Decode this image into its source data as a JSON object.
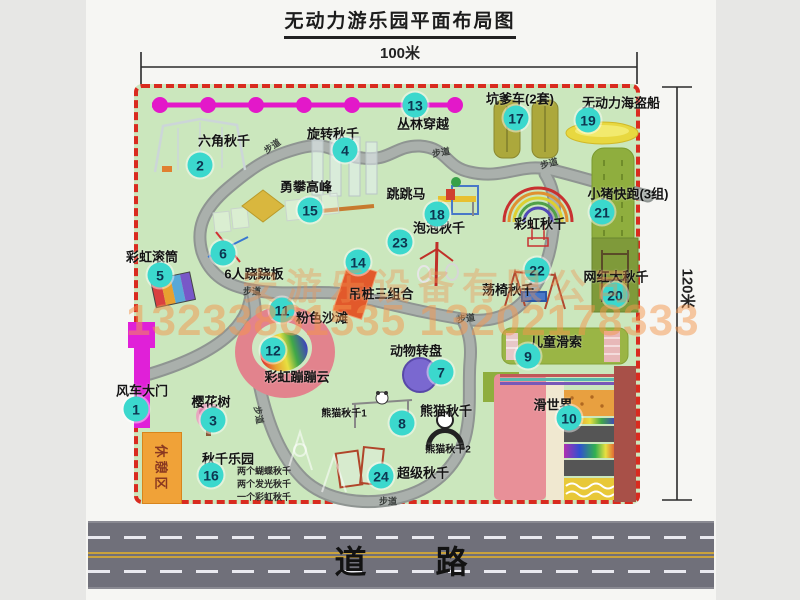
{
  "title": "无动力游乐园平面布局图",
  "dimensions": {
    "width_label": "100米",
    "height_label": "120米"
  },
  "road": {
    "label": "道 路"
  },
  "watermark": {
    "company": "安游乐设备有限公司",
    "phone": "13233861535 13202178333"
  },
  "rest_area_label": "休憩区",
  "walkway_label": "步道",
  "colors": {
    "map-green": "#cbe7bd",
    "border-red": "#d92b1f",
    "badge": "#3bd8cd",
    "road": "#70707a",
    "rest-orange": "#f0a238",
    "magenta": "#e318c9",
    "wm1": "rgba(240,145,80,0.38)",
    "wm2": "rgba(244,150,75,0.5)"
  },
  "items": [
    {
      "num": "1",
      "label": "风车大门",
      "label_pos": [
        142,
        390
      ],
      "badge": [
        136,
        409
      ]
    },
    {
      "num": "2",
      "label": "六角秋千",
      "label_pos": [
        224,
        140
      ],
      "badge": [
        200,
        165
      ]
    },
    {
      "num": "3",
      "label": "樱花树",
      "label_pos": [
        211,
        401
      ],
      "badge": [
        213,
        420
      ]
    },
    {
      "num": "4",
      "label": "旋转秋千",
      "label_pos": [
        333,
        133
      ],
      "badge": [
        345,
        150
      ]
    },
    {
      "num": "5",
      "label": "彩虹滚筒",
      "label_pos": [
        152,
        256
      ],
      "badge": [
        160,
        275
      ]
    },
    {
      "num": "6",
      "label": "6人跷跷板",
      "label_pos": [
        254,
        273
      ],
      "badge": [
        223,
        253
      ]
    },
    {
      "num": "7",
      "label": "动物转盘",
      "label_pos": [
        416,
        350
      ],
      "badge": [
        441,
        372
      ]
    },
    {
      "num": "8",
      "label": "熊猫秋千",
      "label_pos": [
        446,
        410
      ],
      "badge": [
        402,
        423
      ]
    },
    {
      "num": "9",
      "label": "儿童滑索",
      "label_pos": [
        556,
        341
      ],
      "badge": [
        528,
        356
      ]
    },
    {
      "num": "10",
      "label": "滑世界",
      "label_pos": [
        553,
        404
      ],
      "badge": [
        569,
        418
      ]
    },
    {
      "num": "11",
      "label": "粉色沙滩",
      "label_pos": [
        322,
        317
      ],
      "badge": [
        282,
        310
      ]
    },
    {
      "num": "12",
      "label": "彩虹蹦蹦云",
      "label_pos": [
        297,
        376
      ],
      "badge": [
        273,
        350
      ]
    },
    {
      "num": "13",
      "label": "丛林穿越",
      "label_pos": [
        423,
        123
      ],
      "badge": [
        415,
        105
      ]
    },
    {
      "num": "14",
      "label": "吊桩三组合",
      "label_pos": [
        381,
        293
      ],
      "badge": [
        358,
        262
      ]
    },
    {
      "num": "15",
      "label": "勇攀高峰",
      "label_pos": [
        306,
        186
      ],
      "badge": [
        310,
        210
      ]
    },
    {
      "num": "16",
      "label": "秋千乐园",
      "label_pos": [
        228,
        458
      ],
      "badge": [
        211,
        475
      ]
    },
    {
      "num": "17",
      "label": "坑爹车(2套)",
      "label_pos": [
        520,
        98
      ],
      "badge": [
        516,
        118
      ]
    },
    {
      "num": "18",
      "label": "跳跳马",
      "label_pos": [
        406,
        193
      ],
      "badge": [
        437,
        214
      ]
    },
    {
      "num": "19",
      "label": "无动力海盗船",
      "label_pos": [
        621,
        102
      ],
      "badge": [
        588,
        120
      ]
    },
    {
      "num": "20",
      "label": "网红大秋千",
      "label_pos": [
        616,
        276
      ],
      "badge": [
        615,
        295
      ]
    },
    {
      "num": "21",
      "label": "小猪快跑(3组)",
      "label_pos": [
        628,
        193
      ],
      "badge": [
        602,
        212
      ]
    },
    {
      "num": "22",
      "label": "荡椅秋千",
      "label_pos": [
        508,
        289
      ],
      "badge": [
        537,
        270
      ]
    },
    {
      "num": "23",
      "label": "泡泡秋千",
      "label_pos": [
        439,
        227
      ],
      "badge": [
        400,
        242
      ]
    },
    {
      "num": "24",
      "label": "超级秋千",
      "label_pos": [
        423,
        472
      ],
      "badge": [
        381,
        476
      ]
    }
  ],
  "extra_labels": [
    {
      "text": "彩虹秋千",
      "pos": [
        540,
        223
      ],
      "small": false
    },
    {
      "text": "熊猫秋千1",
      "pos": [
        344,
        412
      ],
      "small": true
    },
    {
      "text": "熊猫秋千2",
      "pos": [
        448,
        448
      ],
      "small": true
    }
  ],
  "walkway_positions": [
    {
      "pos": [
        272,
        146
      ],
      "rot": -35
    },
    {
      "pos": [
        441,
        152
      ],
      "rot": -10
    },
    {
      "pos": [
        549,
        163
      ],
      "rot": -15
    },
    {
      "pos": [
        252,
        291
      ],
      "rot": 0
    },
    {
      "pos": [
        259,
        415
      ],
      "rot": 80
    },
    {
      "pos": [
        466,
        318
      ],
      "rot": -8
    },
    {
      "pos": [
        388,
        501
      ],
      "rot": 0
    }
  ],
  "swing_park_notes": {
    "pos": [
      237,
      464
    ],
    "lines": [
      "两个蝴蝶秋千",
      "两个发光秋千",
      "一个彩虹秋千"
    ]
  }
}
